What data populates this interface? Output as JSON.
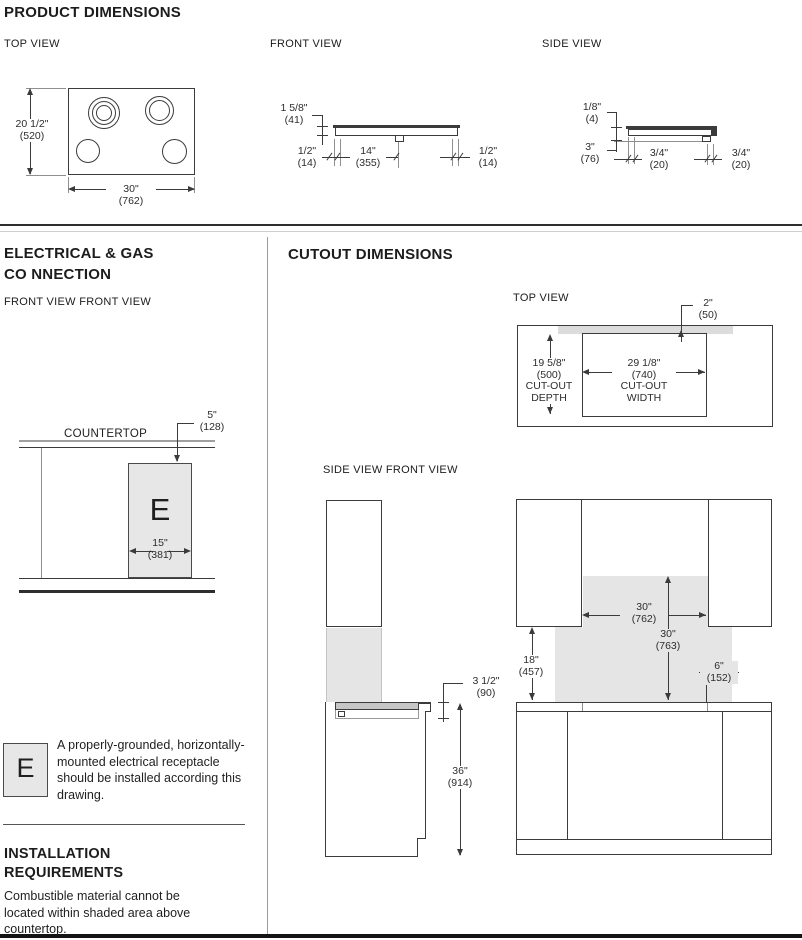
{
  "product_dimensions": {
    "title": "PRODUCT DIMENSIONS",
    "views": {
      "top": "TOP VIEW",
      "front": "FRONT VIEW",
      "side": "SIDE VIEW"
    },
    "top": {
      "height_in": "20 1/2\"",
      "height_mm": "(520)",
      "width_in": "30\"",
      "width_mm": "(762)"
    },
    "front": {
      "height_in": "1 5/8\"",
      "height_mm": "(41)",
      "left_in": "1/2\"",
      "left_mm": "(14)",
      "center_in": "14\"",
      "center_mm": "(355)",
      "right_in": "1/2\"",
      "right_mm": "(14)"
    },
    "side": {
      "lip_in": "1/8\"",
      "lip_mm": "(4)",
      "body_in": "3\"",
      "body_mm": "(76)",
      "front_in": "3/4\"",
      "front_mm": "(20)",
      "rear_in": "3/4\"",
      "rear_mm": "(20)"
    }
  },
  "electrical": {
    "title_line1": "ELECTRICAL & GAS",
    "title_line2": "CO NNECTION",
    "view_label": "FRONT VIEW FRONT VIEW",
    "countertop": "COUNTERTOP",
    "e_symbol": "E",
    "receptacle_offset_in": "5\"",
    "receptacle_offset_mm": "(128)",
    "receptacle_width_in": "15\"",
    "receptacle_width_mm": "(381)",
    "legend_symbol": "E",
    "legend_text": "A properly-grounded, horizontally-mounted electrical receptacle should be installed according this drawing."
  },
  "installation": {
    "title_line1": "INSTALLATION",
    "title_line2": "REQUIREMENTS",
    "body": "Combustible material cannot be located within shaded area above countertop."
  },
  "cutout": {
    "title": "CUTOUT DIMENSIONS",
    "top_view_label": "TOP VIEW",
    "side_front_label": "SIDE VIEW FRONT VIEW",
    "rear_strip_in": "2\"",
    "rear_strip_mm": "(50)",
    "depth_in": "19 5/8\"",
    "depth_mm": "(500)",
    "depth_label1": "CUT-OUT",
    "depth_label2": "DEPTH",
    "width_in": "29 1/8\"",
    "width_mm": "(740)",
    "width_label1": "CUT-OUT",
    "width_label2": "WIDTH",
    "cooktop_depth_in": "3 1/2\"",
    "cooktop_depth_mm": "(90)",
    "counter_height_in": "36\"",
    "counter_height_mm": "(914)",
    "clearance_width_in": "30\"",
    "clearance_width_mm": "(762)",
    "clearance_height_in": "30\"",
    "clearance_height_mm": "(763)",
    "cabinet_height_in": "18\"",
    "cabinet_height_mm": "(457)",
    "side_clearance_in": "6\"",
    "side_clearance_mm": "(152)"
  }
}
